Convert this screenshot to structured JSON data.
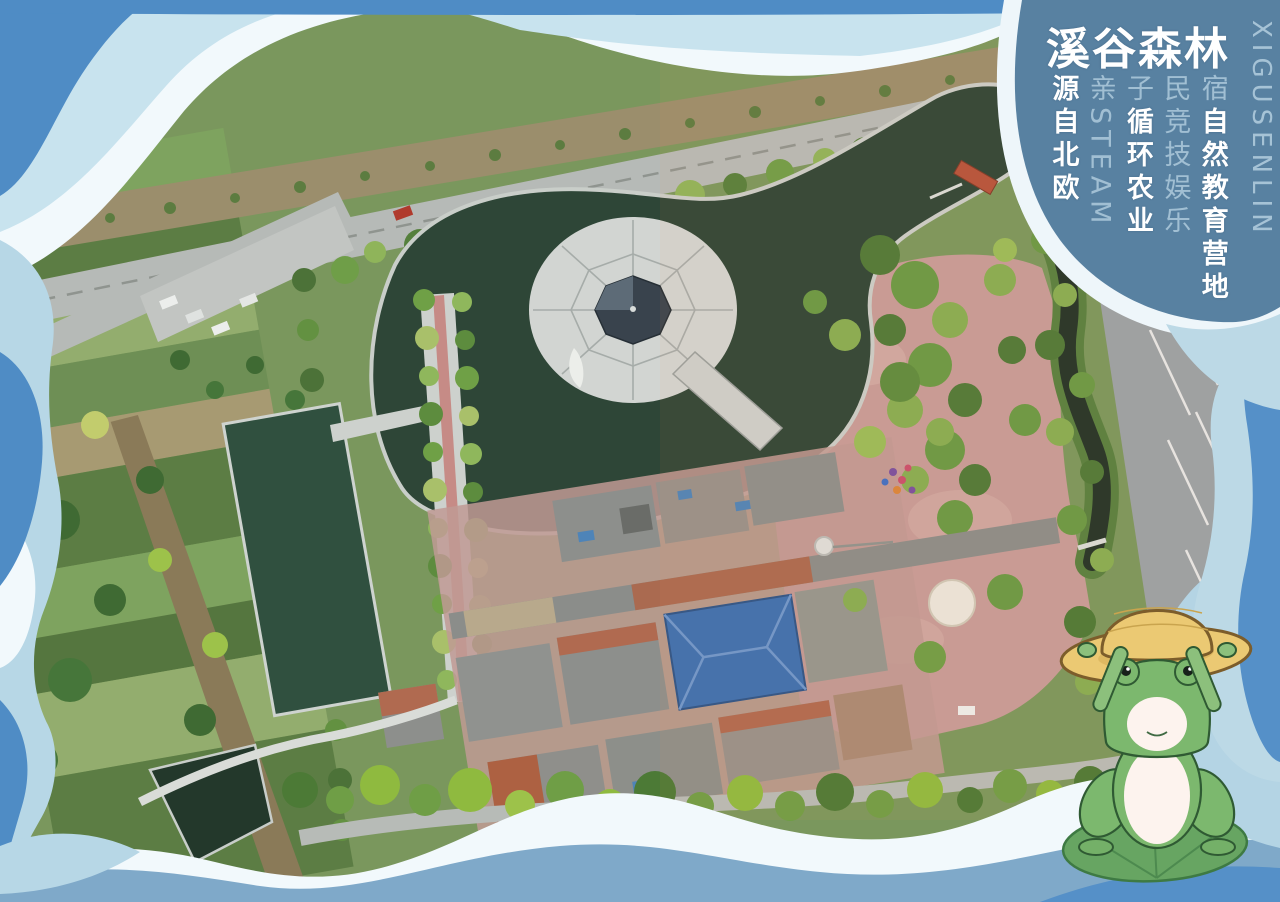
{
  "brand": {
    "title": "溪谷森林",
    "title_latin": "XIGUSENLIN",
    "tagline_columns": [
      {
        "prefix": "",
        "main": "源自北欧"
      },
      {
        "prefix": "亲STEAM",
        "main": ""
      },
      {
        "prefix": "子",
        "main": "循环农业"
      },
      {
        "prefix": "民竞技娱乐",
        "main": ""
      },
      {
        "prefix": "宿",
        "main": "自然教育营地"
      }
    ]
  },
  "scene": {
    "type": "aerial-drone-photograph-poster",
    "mascot": "frog-with-straw-hat-on-lily-pad",
    "landmarks": [
      "island-pavilion-pond",
      "rectangular-pond",
      "tree-lined-walkway",
      "courtyard-buildings",
      "blue-roof-hall",
      "pink-plaza",
      "winding-stream",
      "perimeter-roads",
      "farm-fields"
    ]
  },
  "colors": {
    "frame_blue": "#4f8cc5",
    "frame_steel": "#7fa9c9",
    "frame_pale": "#b7d7e6",
    "frame_white": "#f2f9fc",
    "overlay_blob": "#4b7699",
    "text_bold": "#ffffff",
    "text_light": "#a9cfe2",
    "pond_dark": "#2e4637",
    "plaza_pink": "#c69c98",
    "roof_blue": "#3c70b1",
    "frog_green": "#7cb86e",
    "hat_yellow": "#ebc973"
  }
}
